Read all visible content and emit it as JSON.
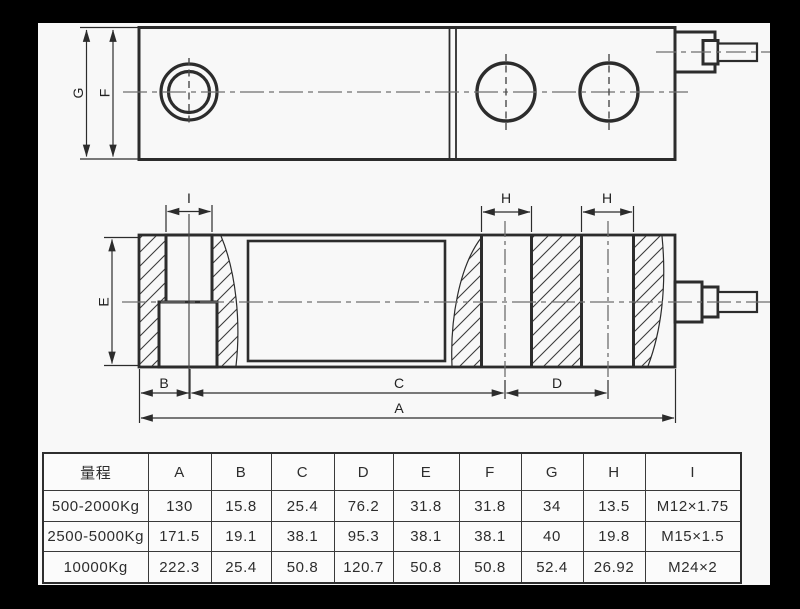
{
  "drawing": {
    "dim_labels": {
      "G": "G",
      "F": "F",
      "E": "E",
      "I": "I",
      "H1": "H",
      "H2": "H",
      "B": "B",
      "C": "C",
      "D": "D",
      "A": "A"
    }
  },
  "table": {
    "headers": [
      "量程",
      "A",
      "B",
      "C",
      "D",
      "E",
      "F",
      "G",
      "H",
      "I"
    ],
    "rows": [
      [
        "500-2000Kg",
        "130",
        "15.8",
        "25.4",
        "76.2",
        "31.8",
        "31.8",
        "34",
        "13.5",
        "M12×1.75"
      ],
      [
        "2500-5000Kg",
        "171.5",
        "19.1",
        "38.1",
        "95.3",
        "38.1",
        "38.1",
        "40",
        "19.8",
        "M15×1.5"
      ],
      [
        "10000Kg",
        "222.3",
        "25.4",
        "50.8",
        "120.7",
        "50.8",
        "50.8",
        "52.4",
        "26.92",
        "M24×2"
      ]
    ]
  },
  "colors": {
    "line": "#2c2c2c",
    "centerline": "#6f6f6f",
    "sheet": "#f8f8f8",
    "frame": "#000000"
  }
}
